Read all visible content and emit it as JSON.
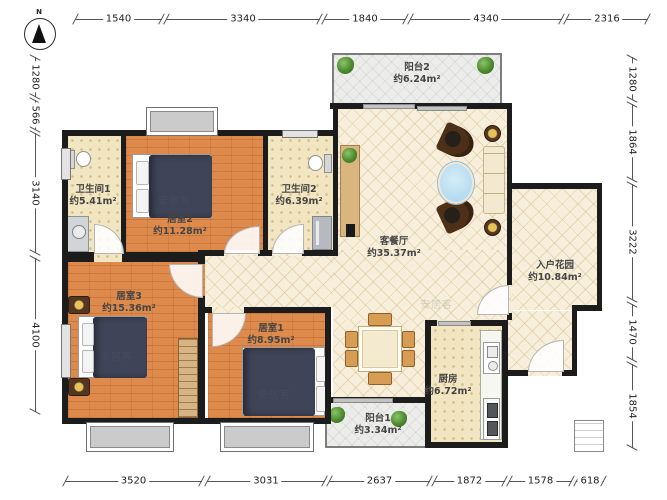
{
  "compass": {
    "label": "N"
  },
  "watermark": {
    "text": "安居客"
  },
  "dimensions": {
    "top": [
      "1540",
      "3340",
      "1840",
      "4340",
      "2316"
    ],
    "left": [
      "1280",
      "566",
      "3140",
      "4100"
    ],
    "right": [
      "1280",
      "1864",
      "3222",
      "1470",
      "1854"
    ],
    "bottom": [
      "3520",
      "3031",
      "2637",
      "1872",
      "1578",
      "618"
    ]
  },
  "rooms": [
    {
      "name": "阳台2",
      "area": "约6.24m²"
    },
    {
      "name": "卫生间1",
      "area": "约5.41m²"
    },
    {
      "name": "居室2",
      "area": "约11.28m²"
    },
    {
      "name": "卫生间2",
      "area": "约6.39m²"
    },
    {
      "name": "客餐厅",
      "area": "约35.37m²"
    },
    {
      "name": "入户花园",
      "area": "约10.84m²"
    },
    {
      "name": "居室3",
      "area": "约15.36m²"
    },
    {
      "name": "居室1",
      "area": "约8.95m²"
    },
    {
      "name": "厨房",
      "area": "约6.72m²"
    },
    {
      "name": "阳台1",
      "area": "约3.34m²"
    }
  ],
  "colors": {
    "wall": "#1c1c1c",
    "wood_floor": "#dd8a4c",
    "tile_floor": "#f2e6c2",
    "living_floor": "#f7efdb",
    "balcony_floor": "#ecedea",
    "bed": "#3f4458",
    "furniture_brown": "#553621",
    "gold_accent": "#c8a03e",
    "plant": "#4c8a30",
    "glass_table": "#b5ddf0"
  }
}
